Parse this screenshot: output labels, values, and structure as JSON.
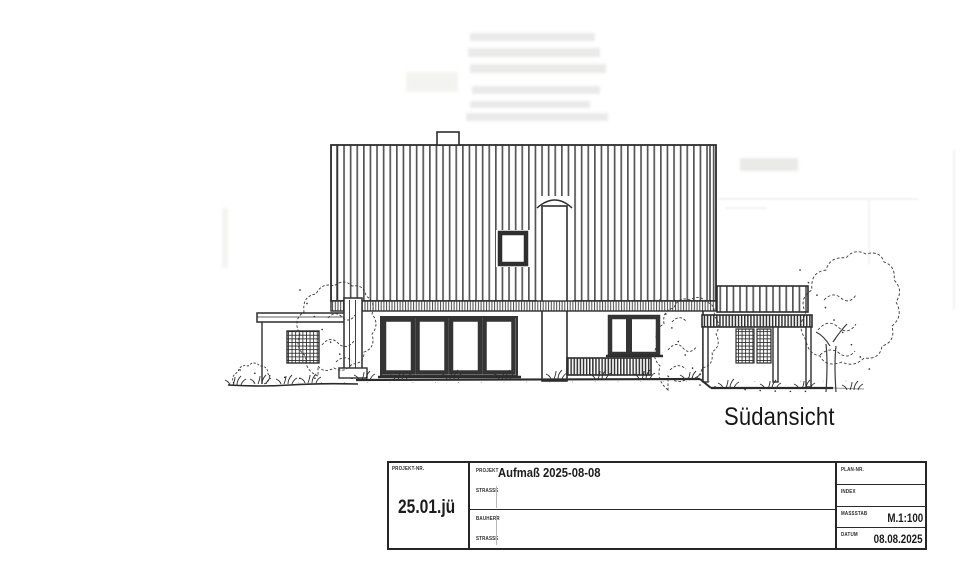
{
  "page": {
    "background_color": "#ffffff",
    "ink_color": "#2d2d2d"
  },
  "drawing": {
    "caption": "Südansicht",
    "elements": [
      "main-roof",
      "ridge-vent",
      "chimney",
      "skylight-window",
      "patio-door",
      "upper-window",
      "terrace-railing",
      "garage-annex",
      "garage-lattice-window",
      "porch-roof",
      "porch-lattice",
      "trees-and-bushes",
      "ground-line"
    ]
  },
  "title_block": {
    "project_nr_label": "PROJEKT-NR.",
    "project_nr_value": "25.01.jü",
    "projekt_label": "PROJEKT",
    "projekt_value": "Aufmaß 2025-08-08",
    "strasse_label": "STRASSE",
    "bauherr_label": "BAUHERR",
    "strasse2_label": "STRASSE",
    "plan_nr_label": "PLAN-NR.",
    "index_label": "INDEX",
    "massstab_label": "MASSSTAB",
    "massstab_value": "M.1:100",
    "datum_label": "DATUM",
    "datum_value": "08.08.2025"
  }
}
